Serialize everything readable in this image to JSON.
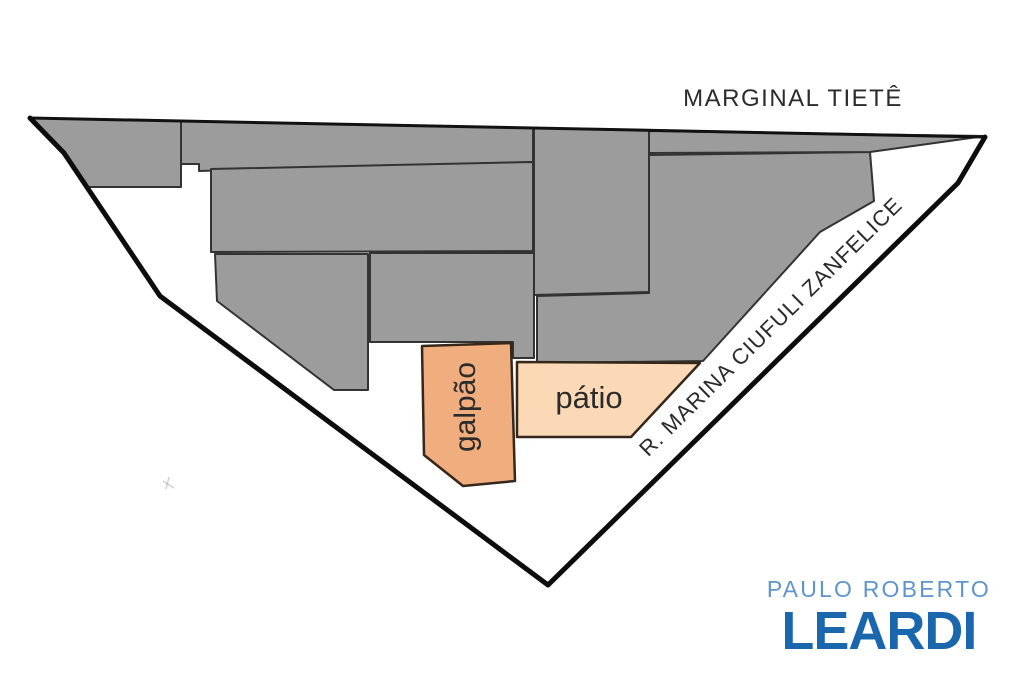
{
  "streets": {
    "top_label": "MARGINAL TIETÊ",
    "right_label": "R. MARINA CIUFULI ZANFELICE"
  },
  "areas": {
    "warehouse_label": "galpão",
    "courtyard_label": "pátio"
  },
  "logo": {
    "top_line": "PAULO ROBERTO",
    "name": "LEARDI"
  },
  "colors": {
    "background": "#ffffff",
    "parcel_fill": "#9c9c9c",
    "parcel_stroke": "#333333",
    "warehouse_fill": "#f0ad7d",
    "courtyard_fill": "#fbd8b6",
    "boundary_stroke": "#0d0d0d",
    "label_text": "#2b2b2b",
    "logo_light_blue": "#6095cc",
    "logo_dark_blue": "#1b67ae"
  }
}
